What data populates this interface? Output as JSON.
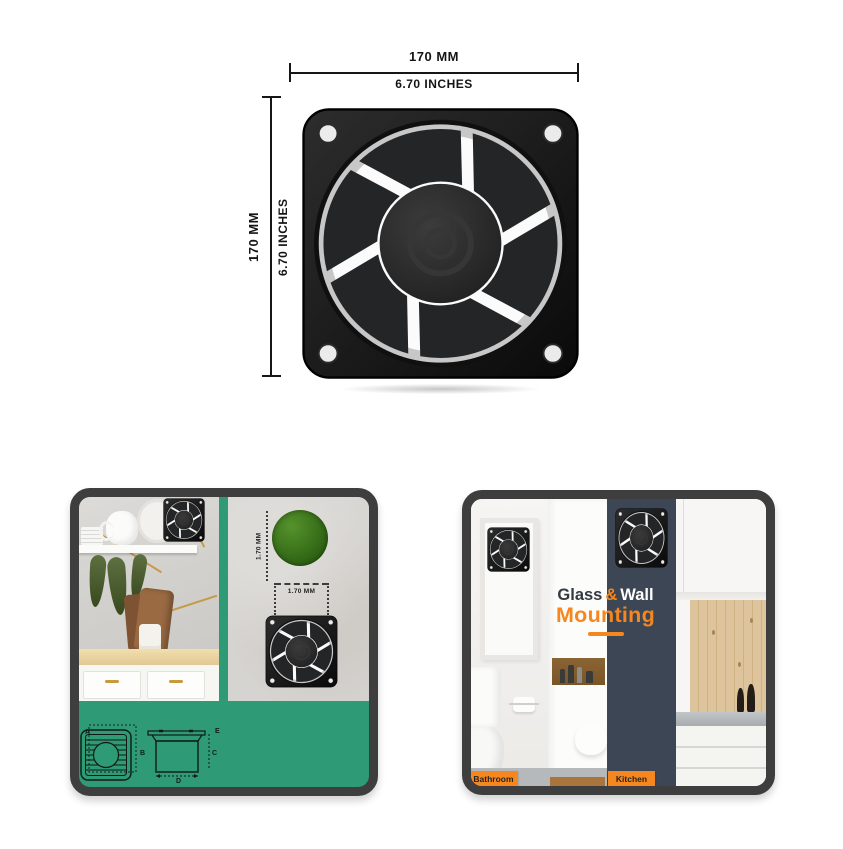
{
  "hero": {
    "dim_top": {
      "mm": "170 MM",
      "inches": "6.70 INCHES"
    },
    "dim_left": {
      "mm": "170 MM",
      "inches": "6.70 INCHES"
    },
    "graphic": "exhaust-fan-front-view"
  },
  "install_card": {
    "dim_vertical": "1.70 MM",
    "dim_horizontal": "1.70 MM",
    "diagram_labels": {
      "a": "A",
      "b": "B",
      "c": "C",
      "d": "D",
      "e": "E"
    }
  },
  "mounting_card": {
    "heading": {
      "glass": "Glass",
      "amp": "&",
      "wall": "Wall",
      "line2": "Mounting"
    },
    "tags": {
      "bathroom": "Bathroom",
      "kitchen": "Kitchen"
    }
  },
  "colors": {
    "accent_orange": "#f6871f",
    "card_green": "#2e9b76",
    "navy_panel": "#3c4655",
    "card_border": "#3e3e3e"
  }
}
